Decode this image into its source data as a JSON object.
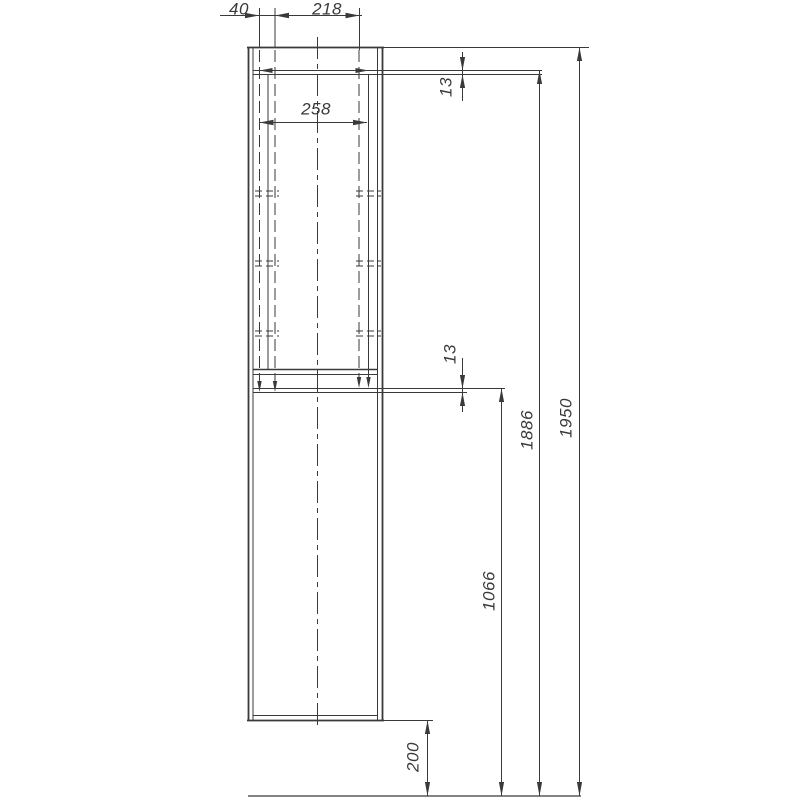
{
  "drawing": {
    "kind": "cabinet-side-elevation-with-dimensions",
    "colors": {
      "line": "#3a3a3a",
      "background": "#ffffff"
    },
    "dims": {
      "top_setback": {
        "value": "40"
      },
      "top_depth": {
        "value": "218"
      },
      "niche_depth": {
        "value": "258"
      },
      "top_panel_thickness": {
        "value": "13"
      },
      "shelf_thickness": {
        "value": "13"
      },
      "door_section_height": {
        "value": "1066"
      },
      "height_to_top_shelf": {
        "value": "1886"
      },
      "total_height": {
        "value": "1950"
      },
      "bottom_clearance": {
        "value": "200"
      }
    }
  }
}
